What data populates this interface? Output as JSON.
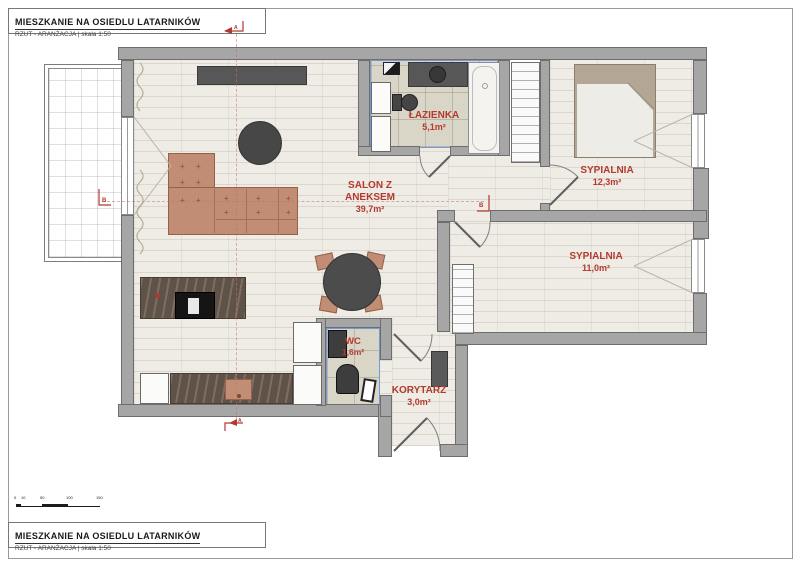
{
  "project": {
    "title": "MIESZKANIE NA OSIEDLU LATARNIKÓW",
    "subtitle": "RZUT - ARANŻACJA |  skala 1:50"
  },
  "rooms": [
    {
      "name": "SALON Z ANEKSEM",
      "area": "39,7m²"
    },
    {
      "name": "ŁAZIENKA",
      "area": "5,1m²"
    },
    {
      "name": "SYPIALNIA",
      "area": "12,3m²"
    },
    {
      "name": "SYPIALNIA",
      "area": "11,0m²"
    },
    {
      "name": "WC",
      "area": "1,6m²"
    },
    {
      "name": "KORYTARZ",
      "area": "3,0m²"
    }
  ],
  "markers": {
    "section_a": "A",
    "section_b": "B"
  },
  "scale_bar": {
    "labels": [
      "0",
      "10",
      "50",
      "100",
      "150"
    ]
  },
  "colors": {
    "label_red": "#b23a2f",
    "wall_gray": "#a6a6a6",
    "sofa_terracotta": "#c18d74",
    "accent_blue": "#5b8fd6",
    "furniture_dark": "#4a4a4a",
    "wood_floor": "#efece5",
    "tile_floor": "#d9d5c7"
  }
}
